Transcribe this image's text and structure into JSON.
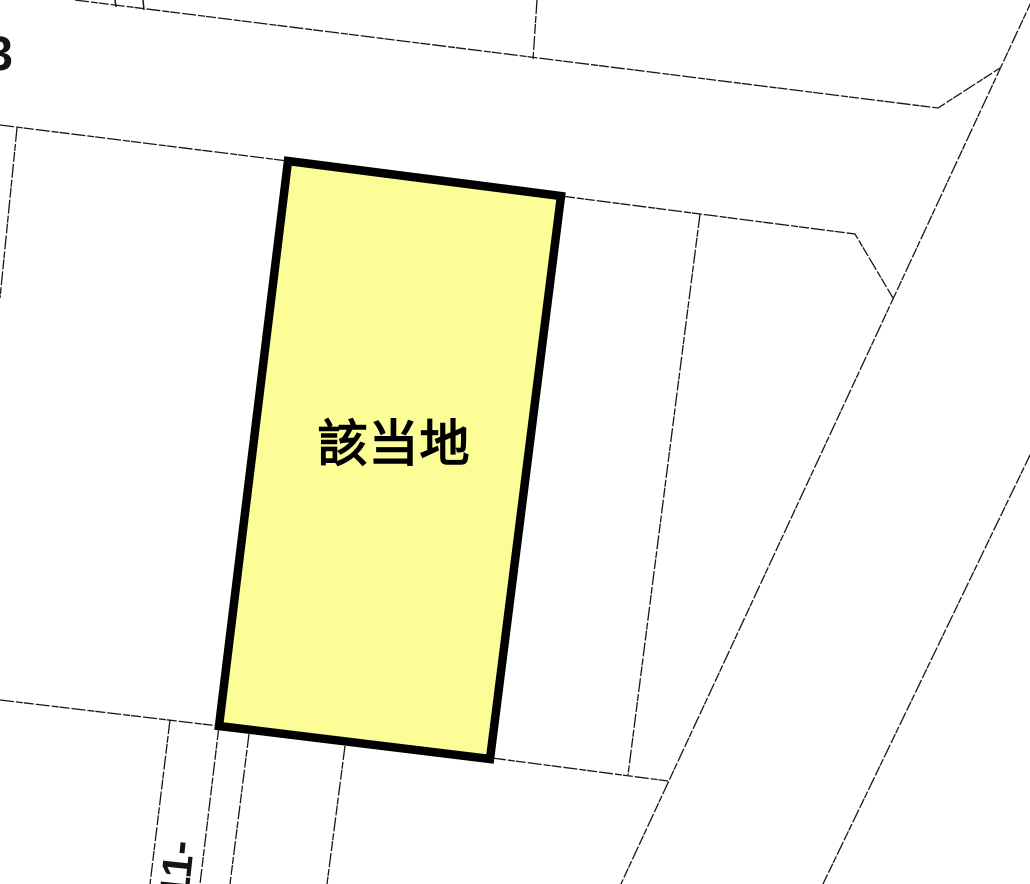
{
  "map": {
    "background": "#ffffff",
    "line_color": "#161616",
    "highlighted_parcel": {
      "label": "該当地",
      "fill": "#fdfd97",
      "border": "#000000"
    },
    "annotations": {
      "top_left_lot_number": "3",
      "bottom_left_lot_number": "11-"
    }
  }
}
